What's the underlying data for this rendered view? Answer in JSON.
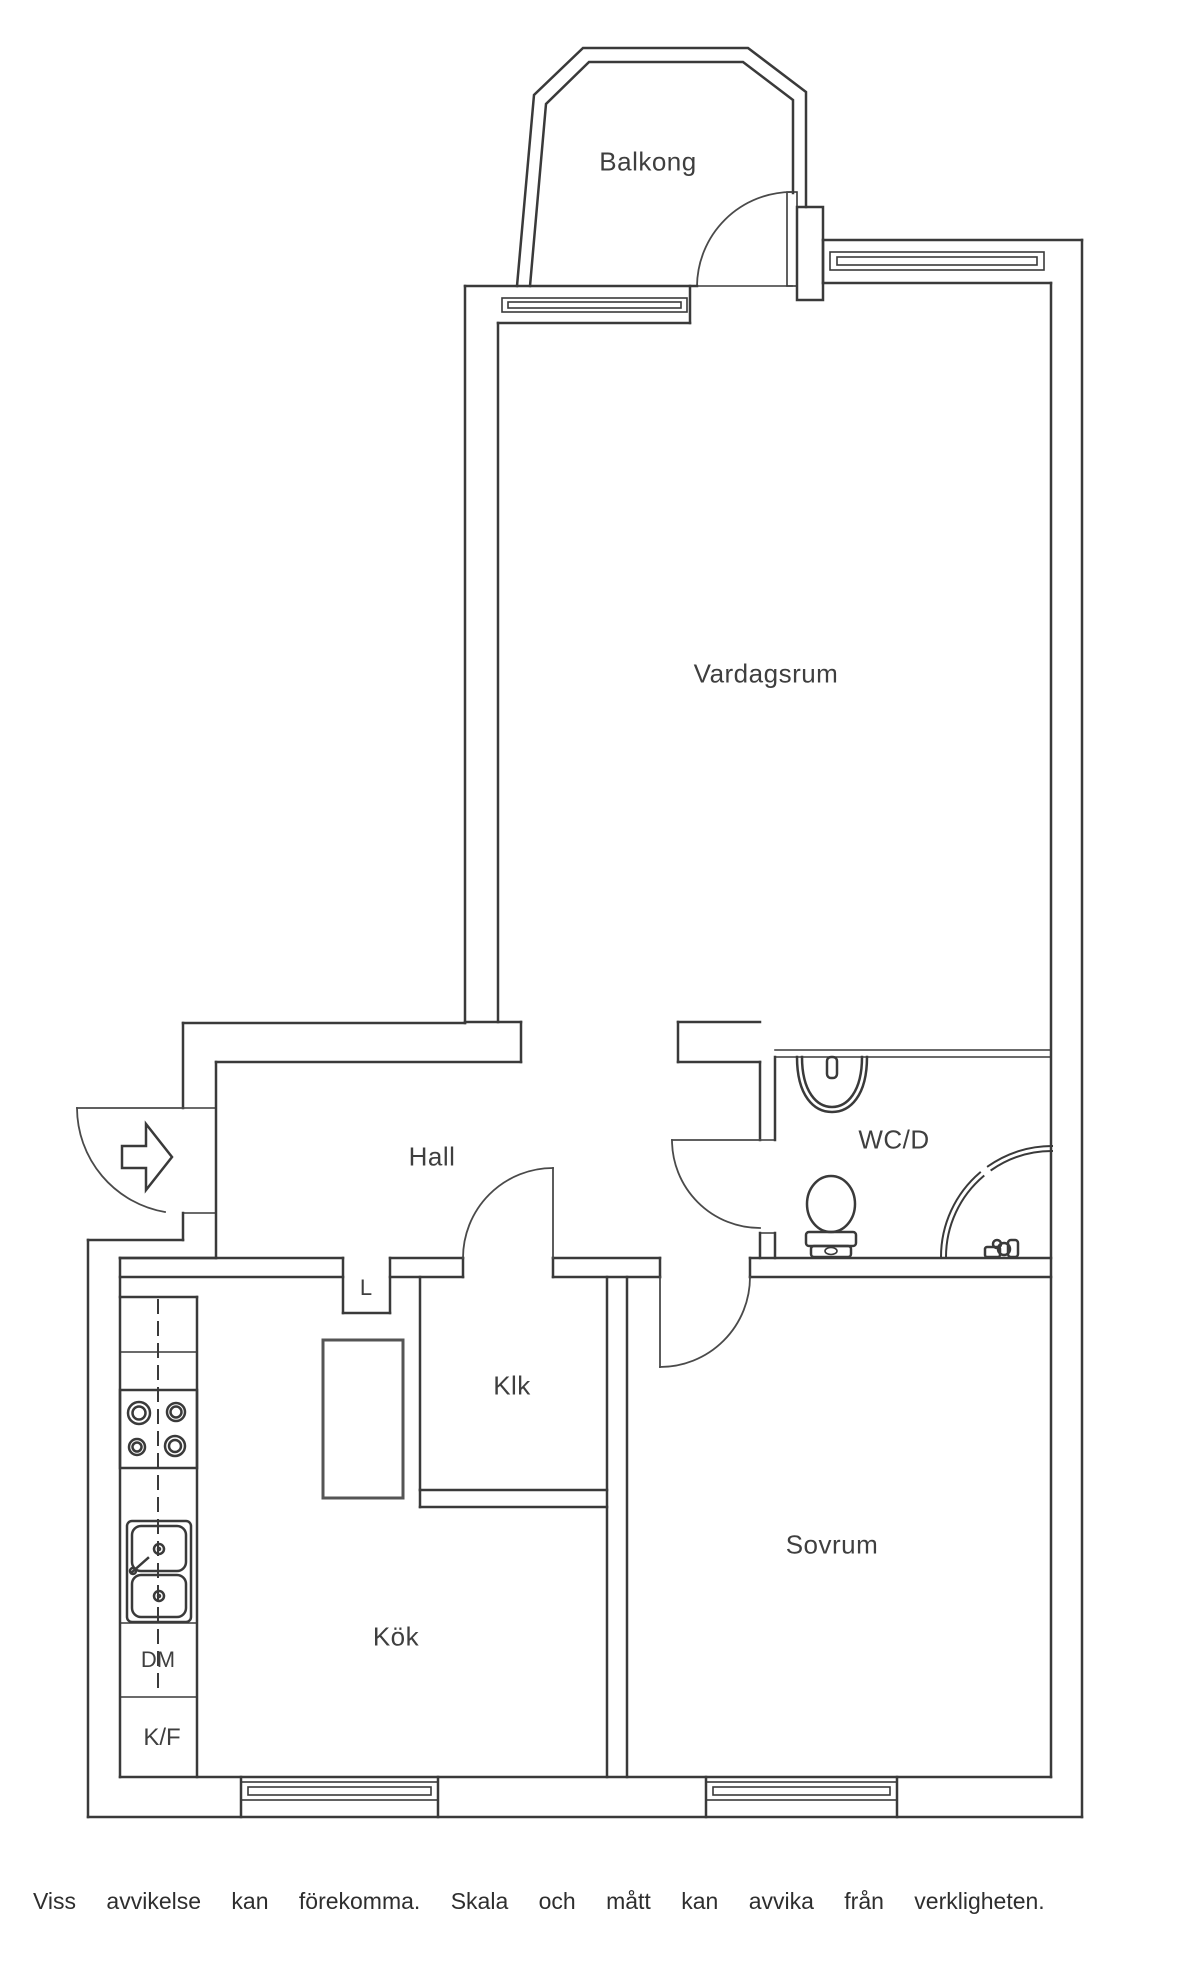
{
  "rooms": [
    {
      "id": "balkong",
      "label": "Balkong"
    },
    {
      "id": "vardagsrum",
      "label": "Vardagsrum"
    },
    {
      "id": "hall",
      "label": "Hall"
    },
    {
      "id": "wcd",
      "label": "WC/D"
    },
    {
      "id": "klk",
      "label": "Klk"
    },
    {
      "id": "sovrum",
      "label": "Sovrum"
    },
    {
      "id": "kok",
      "label": "Kök"
    }
  ],
  "fixture_labels": [
    {
      "id": "linen-closet",
      "label": "L"
    },
    {
      "id": "dishwasher",
      "label": "DM"
    },
    {
      "id": "fridge-freezer",
      "label": "K/F"
    }
  ],
  "disclaimer": "Viss avvikelse kan förekomma. Skala och mått kan avvika från verkligheten.",
  "icons": [
    "stove-icon",
    "kitchen-sink-icon",
    "washbasin-icon",
    "toilet-icon",
    "shower-icon",
    "shower-mixer-icon",
    "entry-arrow-icon",
    "door-swing-arc",
    "window-symbol",
    "counter-centerline"
  ],
  "colors": {
    "wall": "#3a3a3a",
    "stove_fill": "#4a4a4a",
    "burner_ring": "#c3c3c3",
    "burner_center": "#8a8a8a",
    "background": "#ffffff"
  }
}
